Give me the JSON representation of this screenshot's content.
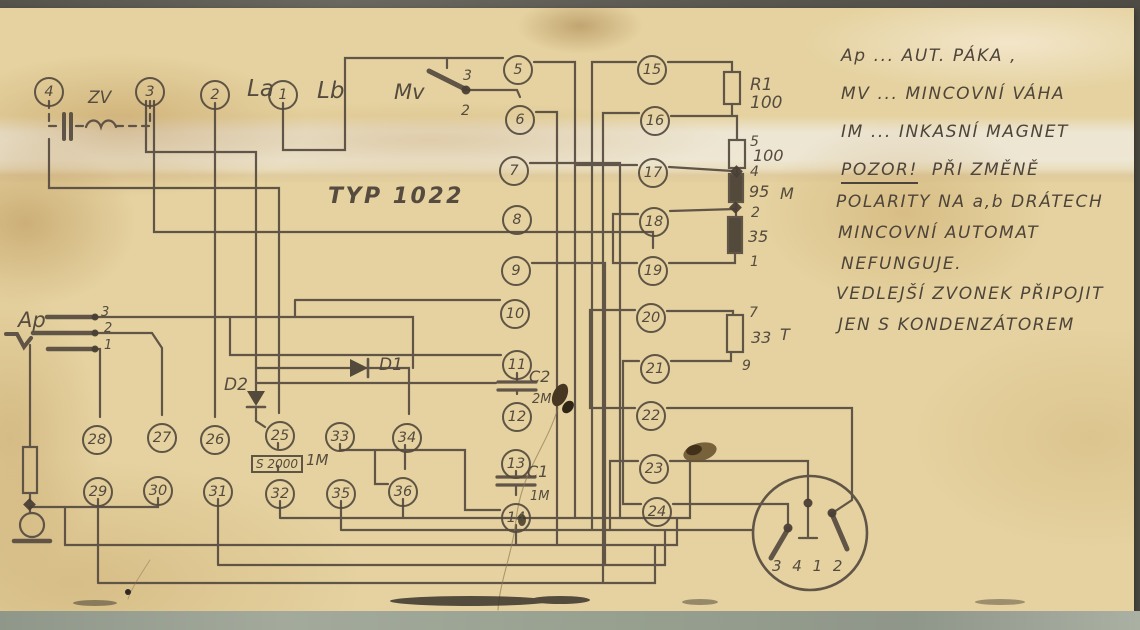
{
  "schematic": {
    "type_label": "TYP 1022",
    "terminals": {
      "1": "1",
      "2": "2",
      "3": "3",
      "4": "4",
      "5": "5",
      "6": "6",
      "7": "7",
      "8": "8",
      "9": "9",
      "10": "10",
      "11": "11",
      "12": "12",
      "13": "13",
      "14": "14",
      "15": "15",
      "16": "16",
      "17": "17",
      "18": "18",
      "19": "19",
      "20": "20",
      "21": "21",
      "22": "22",
      "23": "23",
      "24": "24",
      "25": "25",
      "26": "26",
      "27": "27",
      "28": "28",
      "29": "29",
      "30": "30",
      "31": "31",
      "32": "32",
      "33": "33",
      "34": "34",
      "35": "35",
      "36": "36"
    },
    "component_labels": {
      "la": "La",
      "lb": "Lb",
      "zv": "ZV",
      "mv": "Mv",
      "mv_contact_top": "3",
      "mv_contact_bottom": "2",
      "r1_name": "R1",
      "r1_value": "100",
      "chain_tap_5": "5",
      "chain_r100": "100",
      "chain_tap_4": "4",
      "chain_r95": "95",
      "chain_m": "M",
      "chain_tap_2": "2",
      "chain_r35": "35",
      "chain_tap_1": "1",
      "t_tap_7": "7",
      "t_r33": "33",
      "t_letter": "T",
      "t_tap_9": "9",
      "c2_name": "C2",
      "c2_value": "2M",
      "c1_name": "C1",
      "c1_value": "1M",
      "d1": "D1",
      "d2": "D2",
      "s2000": "S 2000",
      "s2000_value": "1M",
      "ap": "Ap",
      "ap_contact_3": "3",
      "ap_contact_2": "2",
      "ap_contact_1": "1",
      "connector_pins": "3 4 1 2"
    },
    "notes": {
      "legend": [
        "Ap ... AUT. PÁKA ,",
        "MV ... MINCOVNÍ VÁHA",
        "IM ... INKASNÍ MAGNET"
      ],
      "warning_head": "POZOR!",
      "warning_rest": "  PŘI ZMĚNĚ",
      "warning_lines": [
        "POLARITY NA a,b DRÁTECH",
        "MINCOVNÍ AUTOMAT",
        "NEFUNGUJE."
      ],
      "extra_lines": [
        "VEDLEJŠÍ ZVONEK PŘIPOJIT",
        "JEN S KONDENZÁTOREM"
      ]
    },
    "ink_color": "#564c40",
    "paper_color": "#e5d2a0"
  }
}
